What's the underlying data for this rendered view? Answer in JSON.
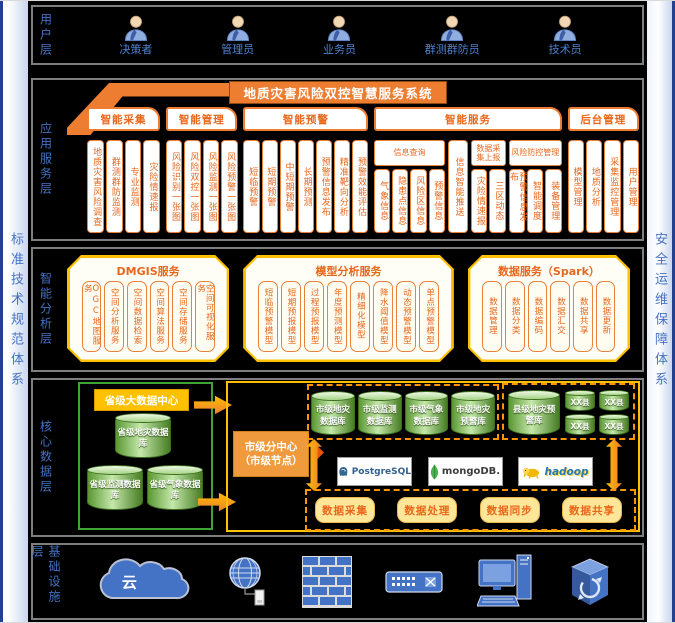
{
  "colors": {
    "accent_orange": "#ed7d31",
    "gold": "#ffc000",
    "blue": "#4472c4",
    "green": "#3fa435"
  },
  "frame": {
    "left_system": "标准技术规范体系",
    "right_system": "安全运维保障体系"
  },
  "user_layer": {
    "label": "用户层",
    "users": [
      "决策者",
      "管理员",
      "业务员",
      "群测群防员",
      "技术员"
    ]
  },
  "app_layer": {
    "label": "应用服务层",
    "banner": "地质灾害风险双控智慧服务系统",
    "sections": {
      "collect": {
        "title": "智能采集",
        "columns": [
          "地质灾害风险调查",
          "群测群防监测",
          "专业监测",
          "灾险情速报"
        ]
      },
      "manage": {
        "title": "智能管理",
        "columns": [
          "风险识别一张图",
          "风险双控一张图",
          "风险监测一张图",
          "风险预警一张图"
        ]
      },
      "warn": {
        "title": "智能预警",
        "columns": [
          "短临预警",
          "短期预警",
          "中短期预警",
          "长期预测",
          "预警信息发布",
          "精准靶向分析",
          "预警效能评估"
        ]
      },
      "service": {
        "title": "智能服务",
        "groups": [
          {
            "header": "信息查询",
            "columns": [
              "气象信息",
              "隐患点信息",
              "风险区信息",
              "预警信息"
            ]
          },
          {
            "header": "",
            "columns": [
              "信息智能推送"
            ]
          },
          {
            "header": "数据采集上报",
            "columns": [
              "灾险情速报",
              "三区动态"
            ]
          },
          {
            "header": "风险防控管理",
            "columns": [
              "预警信息发布",
              "智能调度",
              "装备管理"
            ]
          }
        ]
      },
      "admin": {
        "title": "后台管理",
        "columns": [
          "模型管理",
          "地质分析",
          "采集监控管理",
          "用户管理"
        ]
      }
    }
  },
  "analysis_layer": {
    "label": "智能分析层",
    "boxes": [
      {
        "title": "DMGIS服务",
        "columns": [
          "OGC地图服务",
          "空间分析服务",
          "空间数据检索",
          "空间算法服务",
          "空间存储服务",
          "空间可视化服务"
        ]
      },
      {
        "title": "模型分析服务",
        "columns": [
          "短临预警模型",
          "短期预报模型",
          "过程预报模型",
          "年度预测模型",
          "精细化模型",
          "降水阈值模型",
          "动态预警模型",
          "单点预警模型"
        ]
      },
      {
        "title": "数据服务（Spark）",
        "columns": [
          "数据管理",
          "数据分类",
          "数据编码",
          "数据汇交",
          "数据共享",
          "数据更新"
        ]
      }
    ]
  },
  "data_layer": {
    "label": "核心数据层",
    "provincial": {
      "title": "省级大数据中心",
      "databases": [
        "省级地灾数据库",
        "省级监测数据库",
        "省级气象数据库"
      ]
    },
    "municipal": {
      "title_line1": "市级分中心",
      "title_line2": "（市级节点）",
      "databases": [
        "市级地灾数据库",
        "市级监测数据库",
        "市级气象数据库",
        "市级地灾预警库"
      ],
      "county": {
        "main": "县级地灾预警库",
        "nodes": [
          "XX县",
          "XX县",
          "XX县",
          "XX县"
        ]
      },
      "engines": [
        "PostgreSQL",
        "mongoDB.",
        "hadoop"
      ],
      "services": [
        "数据采集",
        "数据处理",
        "数据同步",
        "数据共享"
      ]
    }
  },
  "infra_layer": {
    "label": "基础设施层",
    "cloud_text": "云"
  }
}
